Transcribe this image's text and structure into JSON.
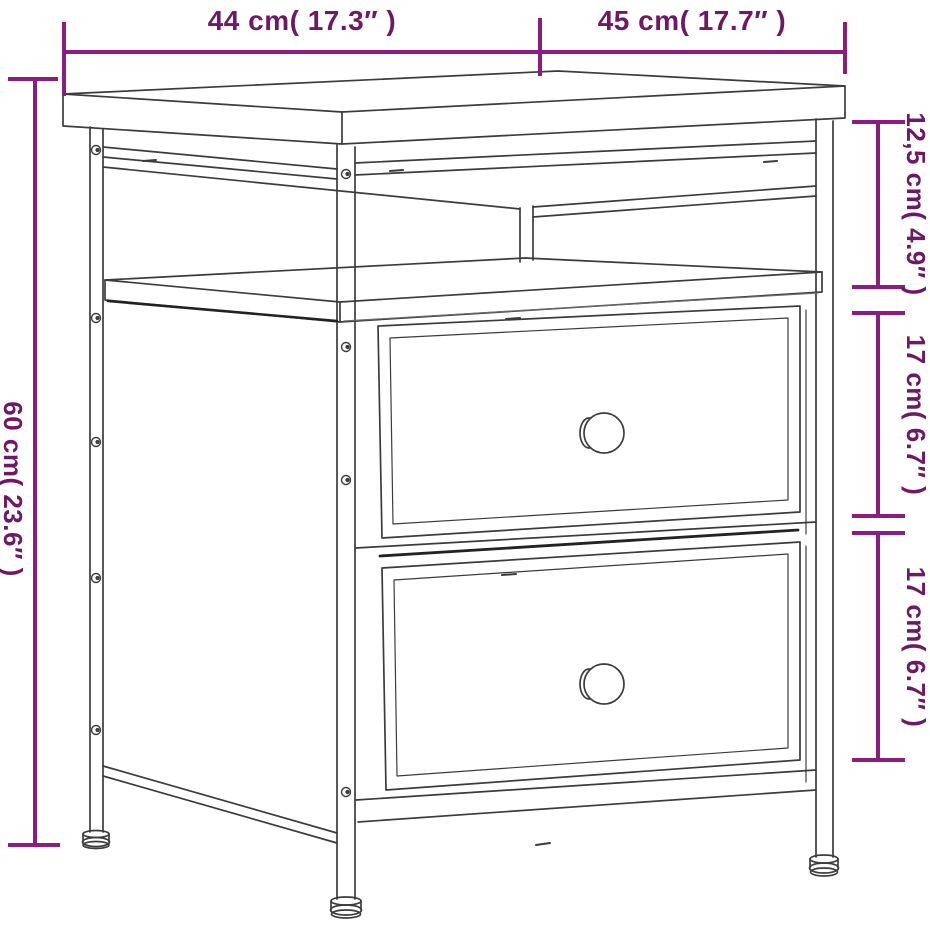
{
  "diagram": {
    "kind": "furniture-dimension-diagram",
    "subject": "nightstand with open shelf and two drawers, perspective line drawing",
    "background": "#ffffff",
    "colors": {
      "dimension_line": "#8d1c7f",
      "dimension_text": "#6e1965",
      "drawing_stroke": "#3c3c3c",
      "drawing_stroke_dark": "#222222"
    },
    "dimensions": {
      "top_width": {
        "label": "44 cm( 17.3″ )",
        "orientation": "horizontal"
      },
      "top_depth": {
        "label": "45 cm( 17.7″ )",
        "orientation": "horizontal"
      },
      "height": {
        "label": "60 cm( 23.6″ )",
        "orientation": "vertical"
      },
      "shelf_opening_height": {
        "label": "12,5 cm( 4.9″ )",
        "orientation": "vertical"
      },
      "drawer1_height": {
        "label": "17 cm( 6.7″ )",
        "orientation": "vertical"
      },
      "drawer2_height": {
        "label": "17 cm( 6.7″ )",
        "orientation": "vertical"
      }
    }
  }
}
